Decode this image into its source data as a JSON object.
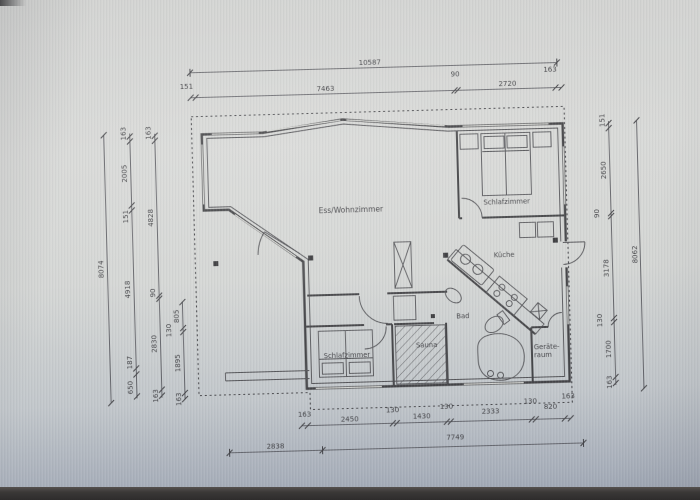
{
  "scene": {
    "type": "architectural floor plan photo",
    "units": "mm"
  },
  "rooms": {
    "living": "Ess/Wohnzimmer",
    "bedroom_main": "Schlafzimmer",
    "kitchen": "Küche",
    "bath": "Bad",
    "sauna": "Sauna",
    "bedroom_small": "Schlafzimmer",
    "utility_line1": "Geräte-",
    "utility_line2": "raum"
  },
  "dims": {
    "top_total": "10587",
    "top_chain": [
      "151",
      "7463",
      "90",
      "2720",
      "163"
    ],
    "left_total": "8074",
    "left_chain_a": [
      "163",
      "2005",
      "151",
      "4918",
      "187",
      "650"
    ],
    "left_chain_b": [
      "163",
      "4828",
      "90",
      "2830",
      "163"
    ],
    "left_chain_c": [
      "805",
      "130",
      "1895",
      "163"
    ],
    "right_total": "8062",
    "right_chain": [
      "151",
      "2650",
      "90",
      "3178",
      "130",
      "1700",
      "163"
    ],
    "bottom_chain": [
      "163",
      "2450",
      "130",
      "1430",
      "130",
      "2333",
      "130",
      "820",
      "163"
    ],
    "bottom_total_left": "2838",
    "bottom_total_right": "7749"
  },
  "colors": {
    "ink": "#3a3a3d",
    "paper": "#d6d7d5",
    "screen_bottom": "#2e2c2c"
  }
}
